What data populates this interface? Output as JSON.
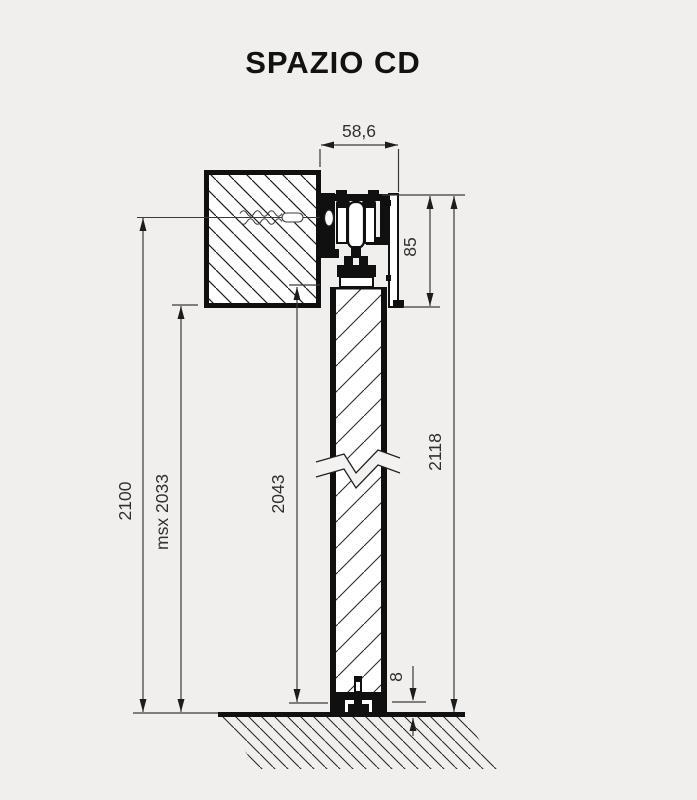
{
  "title": "SPAZIO CD",
  "drawing_type": "sliding-door-system-cross-section",
  "dimensions": {
    "track_width": "58,6",
    "track_height": "85",
    "overall_height_with_track": "2118",
    "overall_height": "2100",
    "max_passage_height": "msx 2033",
    "door_panel_height": "2043",
    "floor_gap": "8"
  },
  "colors": {
    "background": "#f0efee",
    "drawing_line": "#101010",
    "dimension_line": "#3a3a3a",
    "text": "#303030",
    "fill": "#ffffff"
  }
}
